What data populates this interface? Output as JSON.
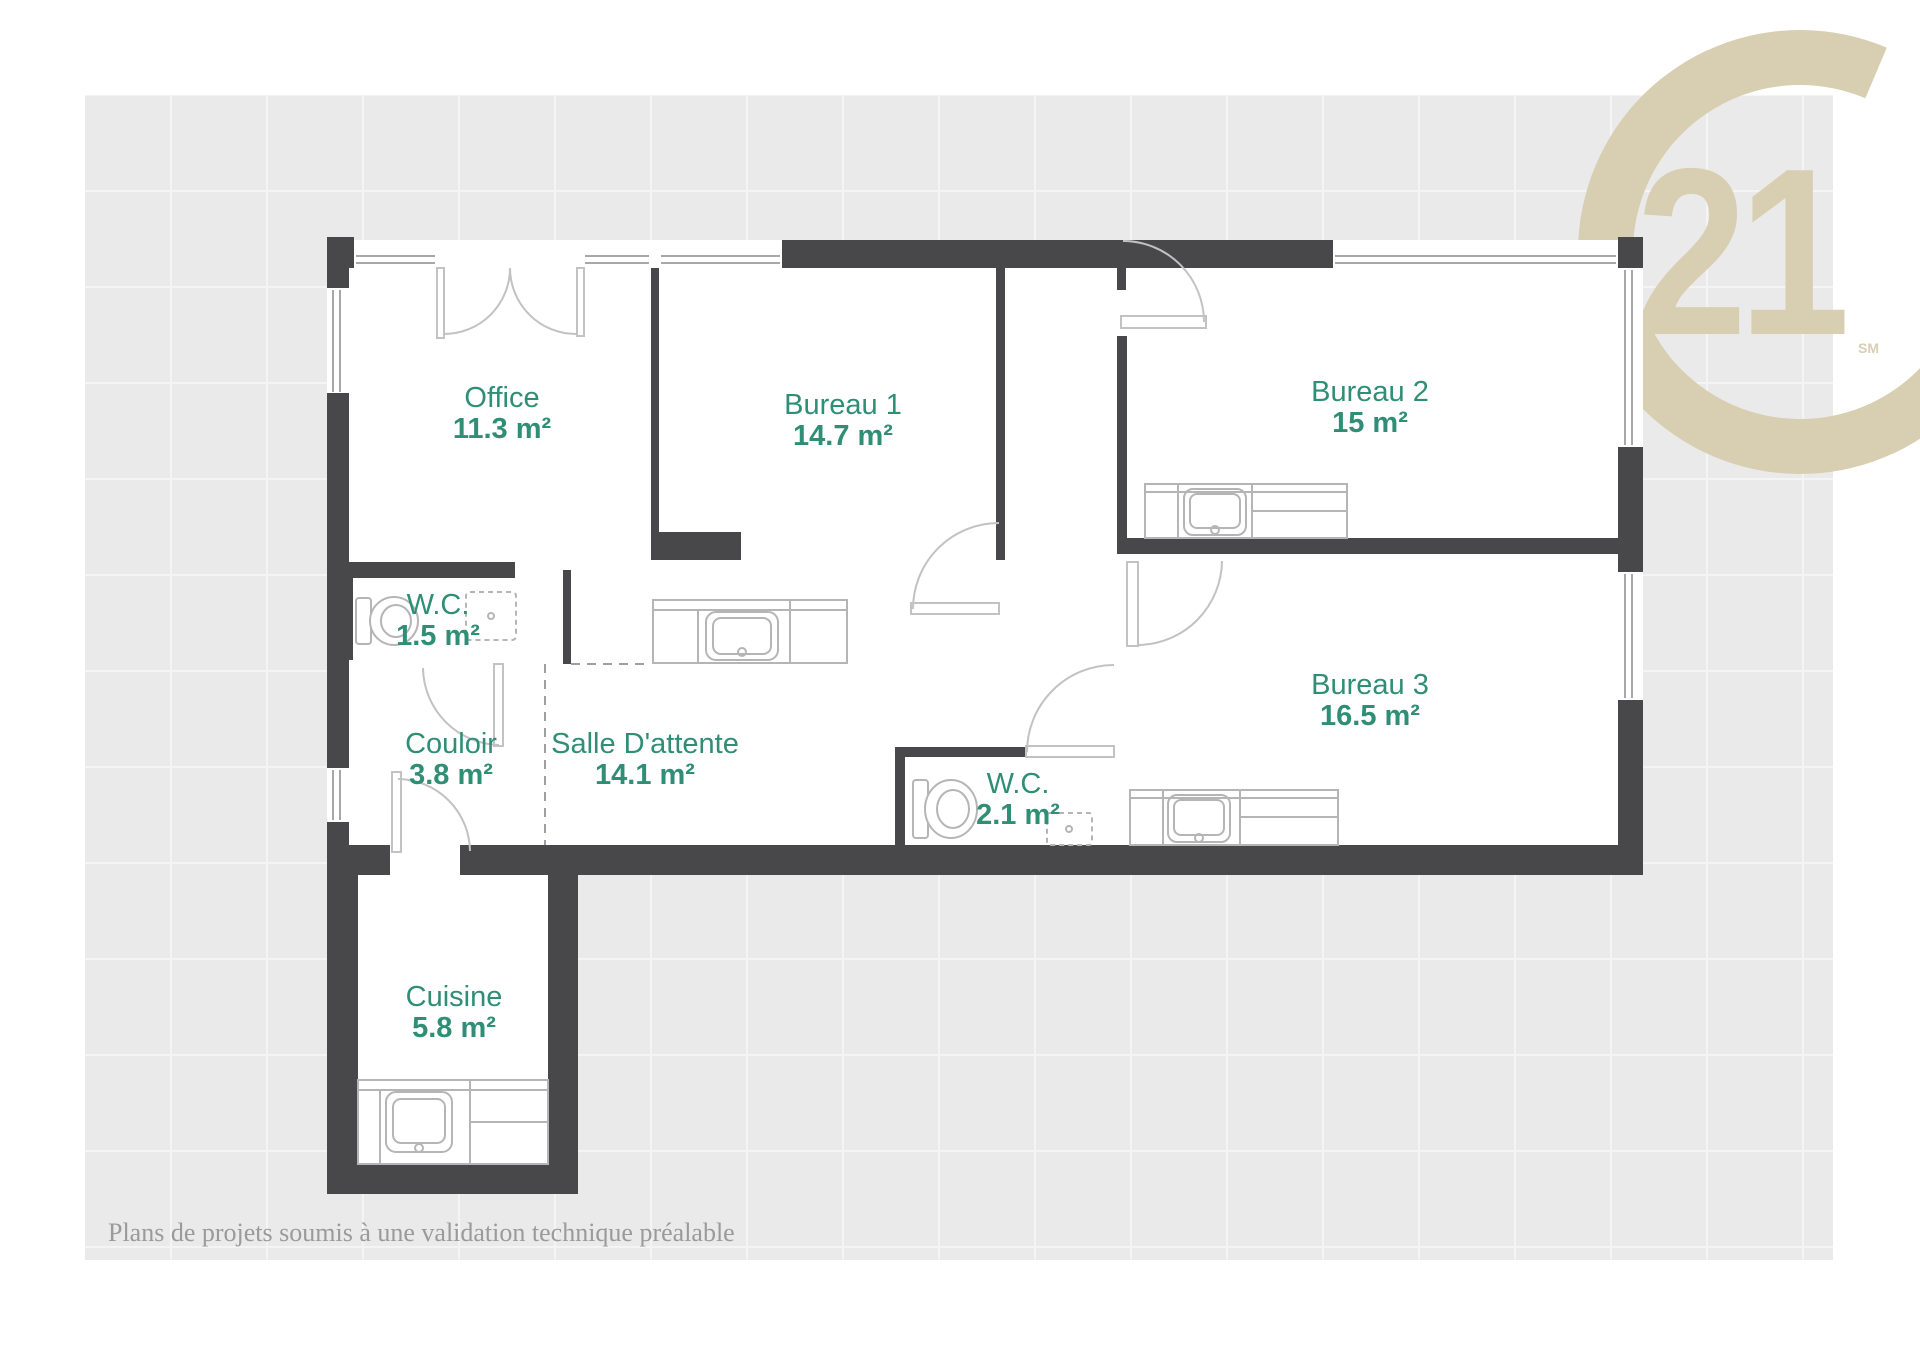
{
  "logo": {
    "brand": "Century 21",
    "number": "21",
    "trademark": "SM"
  },
  "rooms": [
    {
      "id": "office",
      "name": "Office",
      "area": "11.3 m²"
    },
    {
      "id": "bureau1",
      "name": "Bureau 1",
      "area": "14.7 m²"
    },
    {
      "id": "bureau2",
      "name": "Bureau 2",
      "area": "15 m²"
    },
    {
      "id": "bureau3",
      "name": "Bureau 3",
      "area": "16.5 m²"
    },
    {
      "id": "wc1",
      "name": "W.C.",
      "area": "1.5 m²"
    },
    {
      "id": "couloir",
      "name": "Couloir",
      "area": "3.8 m²"
    },
    {
      "id": "salle",
      "name": "Salle D'attente",
      "area": "14.1 m²"
    },
    {
      "id": "wc2",
      "name": "W.C.",
      "area": "2.1 m²"
    },
    {
      "id": "cuisine",
      "name": "Cuisine",
      "area": "5.8 m²"
    }
  ],
  "footer": {
    "disclaimer": "Plans de projets soumis à une validation technique préalable"
  },
  "colors": {
    "wall": "#48484a",
    "background": "#eaeaea",
    "accent_green": "#2f8e75",
    "logo_beige": "#d8cfb2",
    "line_gray": "#b5b5b5",
    "footer_gray": "#9a9a9a"
  }
}
